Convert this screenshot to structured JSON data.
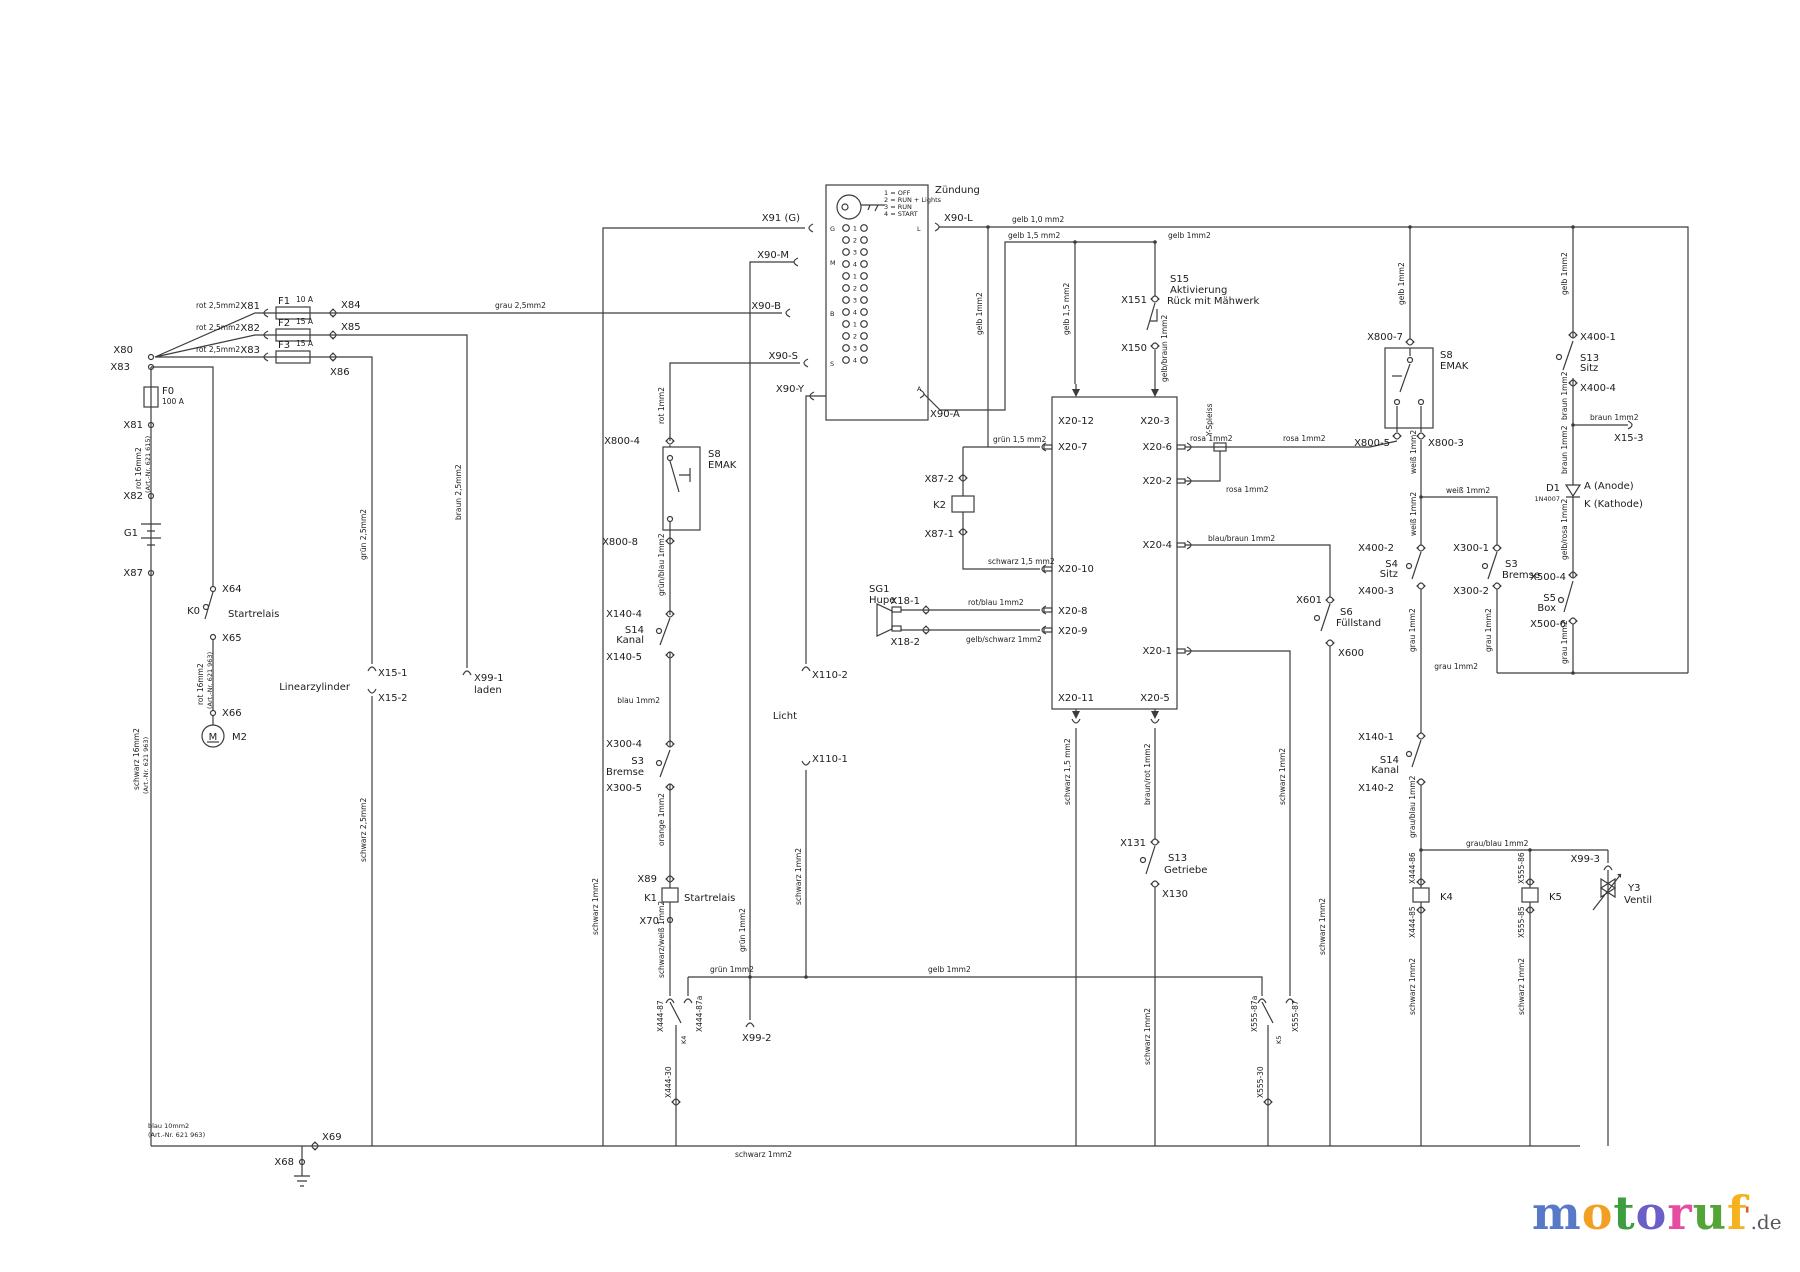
{
  "labels": {
    "zuendung": "Zündung",
    "leg1": "1 = OFF",
    "leg2": "2 = RUN + Lights",
    "leg3": "3 = RUN",
    "leg4": "4 = START",
    "x91g": "X91 (G)",
    "x90m": "X90-M",
    "x90b": "X90-B",
    "x90s": "X90-S",
    "x90y": "X90-Y",
    "x90l": "X90-L",
    "x90a": "X90-A",
    "tg": "G",
    "tm": "M",
    "tb": "B",
    "ts": "S",
    "tl": "L",
    "ta": "A",
    "x80": "X80",
    "x83": "X83",
    "f0": "F0",
    "f0a": "100 A",
    "x81": "X81",
    "x82": "X82",
    "g1": "G1",
    "x87": "X87",
    "w_rot16_615a": "rot 16mm2",
    "w_rot16_615b": "(Art.-Nr. 621 615)",
    "w_schw16a": "schwarz 16mm2",
    "w_schw16b": "(Art.-Nr. 621 963)",
    "r1w": "rot 2,5mm2",
    "r1x": "X81",
    "f1": "F1",
    "f1a": "10 A",
    "x84": "X84",
    "r2w": "rot 2,5mm2",
    "r2x": "X82",
    "f2": "F2",
    "f2a": "15 A",
    "x85": "X85",
    "r3w": "rot 2,5mm2",
    "r3x": "X83",
    "f3": "F3",
    "f3a": "15 A",
    "x86": "X86",
    "w_grau25": "grau 2,5mm2",
    "w_braun25": "braun 2,5mm2",
    "x99_1": "X99-1",
    "laden": "laden",
    "w_gruen25": "grün 2,5mm2",
    "linz": "Linearzylinder",
    "x15_1": "X15-1",
    "x15_2": "X15-2",
    "w_schw25": "schwarz 2,5mm2",
    "x64": "X64",
    "k0": "K0",
    "k0n": "Startrelais",
    "x65": "X65",
    "w_rot16_963a": "rot 16mm2",
    "w_rot16_963b": "(Art.-Nr. 621 963)",
    "x66": "X66",
    "m2": "M2",
    "mm": "M",
    "w_blau10": "blau 10mm2",
    "w_blau10b": "(Art.-Nr. 621 963)",
    "x69": "X69",
    "x68": "X68",
    "w_schw1_bus": "schwarz 1mm2",
    "w_rot1": "rot 1mm2",
    "x800_4": "X800-4",
    "s8l": "S8",
    "emakl": "EMAK",
    "x800_8": "X800-8",
    "w_gnbl1": "grün/blau 1mm2",
    "x140_4": "X140-4",
    "s14l": "S14",
    "kanall": "Kanal",
    "x140_5": "X140-5",
    "w_blau1": "blau 1mm2",
    "x300_4": "X300-4",
    "s3l": "S3",
    "bremsel": "Bremse",
    "x300_5": "X300-5",
    "w_or1": "orange 1mm2",
    "x89": "X89",
    "k1": "K1",
    "k1n": "Startrelais",
    "x70": "X70",
    "w_swws1": "schwarz/weiß 1mm2",
    "x444_87": "X444-87",
    "x444_87a": "X444-87a",
    "k4s": "K4",
    "x444_30": "X444-30",
    "w_schw1_l": "schwarz 1mm2",
    "w_gruen1_v": "grün 1mm2",
    "x99_2": "X99-2",
    "w_gruen1_h": "grün 1mm2",
    "w_gelb1_h": "gelb 1mm2",
    "x110_2": "X110-2",
    "licht": "Licht",
    "x110_1": "X110-1",
    "w_schw1_r": "schwarz 1mm2",
    "x87_2": "X87-2",
    "k2": "K2",
    "x87_1": "X87-1",
    "w_gn15": "grün 1,5 mm2",
    "w_sw15": "schwarz 1,5 mm2",
    "sg1": "SG1",
    "hupe": "Hupe",
    "x18_1": "X18-1",
    "x18_2": "X18-2",
    "w_rtbl1": "rot/blau 1mm2",
    "w_gbsw1": "gelb/schwarz 1mm2",
    "x20_12": "X20-12",
    "x20_3": "X20-3",
    "x20_7": "X20-7",
    "x20_10": "X20-10",
    "x20_8": "X20-8",
    "x20_9": "X20-9",
    "x20_6": "X20-6",
    "x20_2": "X20-2",
    "x20_4": "X20-4",
    "x20_1": "X20-1",
    "x20_11": "X20-11",
    "x20_5": "X20-5",
    "w_gelb10": "gelb 1,0 mm2",
    "w_gelb15a": "gelb 1,5 mm2",
    "w_gelb1a": "gelb 1mm2",
    "w_gelb1b": "gelb 1mm2",
    "w_gelb15b": "gelb 1,5 mm2",
    "s15": "S15",
    "s15b": "Aktivierung",
    "s15c": "Rück mit Mähwerk",
    "x151": "X151",
    "x150": "X150",
    "w_gbbr1": "gelb/braun 1mm2",
    "w_gelb1c": "gelb 1mm2",
    "w_gelb1d": "gelb 1mm2",
    "x800_7": "X800-7",
    "s8r": "S8",
    "emakr": "EMAK",
    "x800_5": "X800-5",
    "x800_3": "X800-3",
    "w_rosa1a": "rosa 1mm2",
    "yspl": "Y-Spleiss",
    "w_rosa1b": "rosa 1mm2",
    "w_rosa1c": "rosa 1mm2",
    "w_weiss1a": "weiß 1mm2",
    "w_weiss1b": "weiß 1mm2",
    "w_weiss1c": "weiß 1mm2",
    "x400_2": "X400-2",
    "s4": "S4",
    "sitz4": "Sitz",
    "x400_3": "X400-3",
    "x300_1": "X300-1",
    "s3r": "S3",
    "bremser": "Bremse",
    "x300_2": "X300-2",
    "w_grau1c": "grau 1mm2",
    "w_grau1d": "grau 1mm2",
    "x140_1": "X140-1",
    "s14r": "S14",
    "kanalr": "Kanal",
    "x140_2": "X140-2",
    "w_grbl1a": "grau/blau 1mm2",
    "w_grbl1b": "grau/blau 1mm2",
    "x444_86": "X444-86",
    "k4": "K4",
    "x444_85": "X444-85",
    "w_schw1_k4c": "schwarz 1mm2",
    "x555_86": "X555-86",
    "k5": "K5",
    "x555_85": "X555-85",
    "w_schw1_k5c": "schwarz 1mm2",
    "x99_3": "X99-3",
    "y3": "Y3",
    "ventil": "Ventil",
    "x400_1": "X400-1",
    "s13r": "S13",
    "sitz13": "Sitz",
    "x400_4": "X400-4",
    "w_braun1a": "braun 1mm2",
    "w_braun1b": "braun 1mm2",
    "x15_3": "X15-3",
    "w_braun1c": "braun 1mm2",
    "d1": "D1",
    "d1t": "1N4007",
    "anode": "A (Anode)",
    "kathode": "K (Kathode)",
    "w_gbrs1": "gelb/rosa 1mm2",
    "x500_4": "X500-4",
    "s5": "S5",
    "box5": "Box",
    "x500_6": "X500-6",
    "w_grau1a": "grau 1mm2",
    "w_grau1b": "grau 1mm2",
    "w_blbr1": "blau/braun 1mm2",
    "x601": "X601",
    "s6": "S6",
    "fuell": "Füllstand",
    "x600": "X600",
    "w_schw1_s6": "schwarz 1mm2",
    "w_brrt1": "braun/rot 1mm2",
    "x131": "X131",
    "s13g": "S13",
    "getriebe": "Getriebe",
    "x130": "X130",
    "w_schw1_g": "schwarz 1mm2",
    "w_sw15b": "schwarz 1,5 mm2",
    "w_schw1_x201": "schwarz 1mm2",
    "x555_87a": "X555-87a",
    "x555_87": "X555-87",
    "k5s": "K5",
    "x555_30": "X555-30"
  },
  "pin_numbers": [
    "1",
    "2",
    "3",
    "4"
  ],
  "logo": {
    "text": "motoruf",
    "suffix": ".de",
    "mark": "'",
    "letter_colors": [
      "#5878C8",
      "#F2A024",
      "#3C9E40",
      "#6A5FC8",
      "#E64C9F",
      "#55A437",
      "#F5B11E"
    ],
    "mark_color": "#E05A2B",
    "suffix_color": "#595959"
  }
}
